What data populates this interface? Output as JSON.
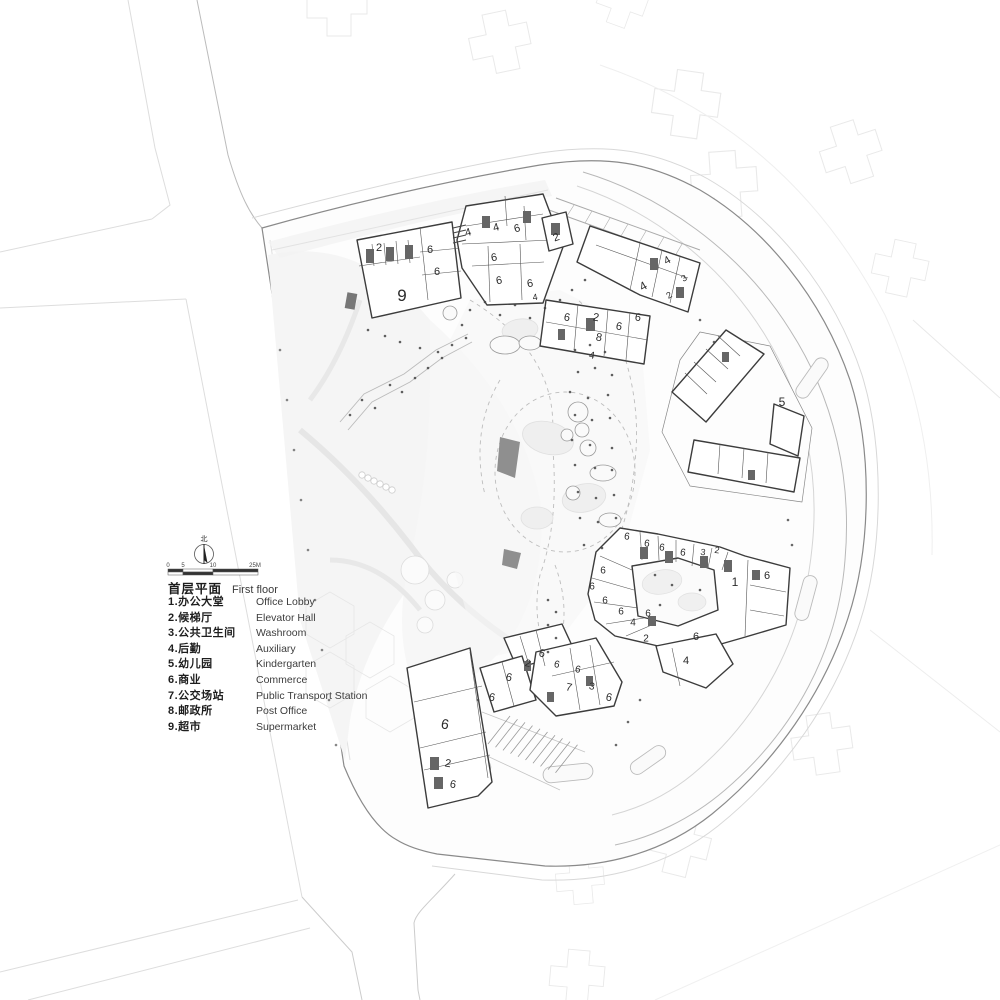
{
  "legend": {
    "title_zh": "首层平面",
    "title_en": "First floor",
    "compass_label": "北",
    "scale_labels": [
      "0",
      "5",
      "10",
      "25M"
    ],
    "items": [
      {
        "num": "1",
        "zh": "办公大堂",
        "en": "Office Lobby"
      },
      {
        "num": "2",
        "zh": "候梯厅",
        "en": "Elevator Hall"
      },
      {
        "num": "3",
        "zh": "公共卫生间",
        "en": "Washroom"
      },
      {
        "num": "4",
        "zh": "后勤",
        "en": "Auxiliary"
      },
      {
        "num": "5",
        "zh": "幼儿园",
        "en": "Kindergarten"
      },
      {
        "num": "6",
        "zh": "商业",
        "en": "Commerce"
      },
      {
        "num": "7",
        "zh": "公交场站",
        "en": "Public Transport Station"
      },
      {
        "num": "8",
        "zh": "邮政所",
        "en": "Post Office"
      },
      {
        "num": "9",
        "zh": "超市",
        "en": "Supermarket"
      }
    ]
  },
  "plan": {
    "labels": [
      {
        "x": 379,
        "y": 247,
        "t": "2",
        "s": 11,
        "r": 0
      },
      {
        "x": 430,
        "y": 249,
        "t": "6",
        "s": 11,
        "r": 0
      },
      {
        "x": 437,
        "y": 271,
        "t": "6",
        "s": 11,
        "r": 0
      },
      {
        "x": 402,
        "y": 295,
        "t": "9",
        "s": 17,
        "r": 0
      },
      {
        "x": 468,
        "y": 232,
        "t": "4",
        "s": 11,
        "r": -15
      },
      {
        "x": 496,
        "y": 227,
        "t": "4",
        "s": 11,
        "r": -15
      },
      {
        "x": 517,
        "y": 228,
        "t": "6",
        "s": 11,
        "r": -15
      },
      {
        "x": 494,
        "y": 257,
        "t": "6",
        "s": 11,
        "r": -10
      },
      {
        "x": 499,
        "y": 280,
        "t": "6",
        "s": 11,
        "r": -10
      },
      {
        "x": 530,
        "y": 283,
        "t": "6",
        "s": 11,
        "r": -10
      },
      {
        "x": 535,
        "y": 297,
        "t": "4",
        "s": 9,
        "r": -10
      },
      {
        "x": 556,
        "y": 237,
        "t": "2",
        "s": 11,
        "r": -20
      },
      {
        "x": 667,
        "y": 260,
        "t": "4",
        "s": 11,
        "r": -30
      },
      {
        "x": 643,
        "y": 286,
        "t": "4",
        "s": 12,
        "r": -30
      },
      {
        "x": 684,
        "y": 278,
        "t": "3",
        "s": 9,
        "r": -30
      },
      {
        "x": 669,
        "y": 295,
        "t": "2",
        "s": 9,
        "r": -30
      },
      {
        "x": 567,
        "y": 317,
        "t": "6",
        "s": 11,
        "r": 10
      },
      {
        "x": 596,
        "y": 317,
        "t": "2",
        "s": 11,
        "r": 10
      },
      {
        "x": 638,
        "y": 317,
        "t": "6",
        "s": 11,
        "r": 10
      },
      {
        "x": 619,
        "y": 326,
        "t": "6",
        "s": 11,
        "r": 10
      },
      {
        "x": 599,
        "y": 337,
        "t": "8",
        "s": 11,
        "r": 10
      },
      {
        "x": 592,
        "y": 355,
        "t": "4",
        "s": 10,
        "r": 10
      },
      {
        "x": 782,
        "y": 402,
        "t": "5",
        "s": 12,
        "r": 0
      },
      {
        "x": 627,
        "y": 536,
        "t": "6",
        "s": 10,
        "r": 8
      },
      {
        "x": 647,
        "y": 543,
        "t": "6",
        "s": 10,
        "r": 8
      },
      {
        "x": 662,
        "y": 547,
        "t": "6",
        "s": 10,
        "r": 8
      },
      {
        "x": 683,
        "y": 552,
        "t": "6",
        "s": 10,
        "r": 8
      },
      {
        "x": 703,
        "y": 552,
        "t": "3",
        "s": 9,
        "r": 8
      },
      {
        "x": 717,
        "y": 550,
        "t": "2",
        "s": 9,
        "r": 8
      },
      {
        "x": 735,
        "y": 582,
        "t": "1",
        "s": 12,
        "r": 0
      },
      {
        "x": 767,
        "y": 575,
        "t": "6",
        "s": 11,
        "r": 0
      },
      {
        "x": 603,
        "y": 570,
        "t": "6",
        "s": 10,
        "r": 0
      },
      {
        "x": 592,
        "y": 586,
        "t": "6",
        "s": 10,
        "r": 0
      },
      {
        "x": 605,
        "y": 600,
        "t": "6",
        "s": 10,
        "r": 0
      },
      {
        "x": 621,
        "y": 611,
        "t": "6",
        "s": 10,
        "r": 0
      },
      {
        "x": 648,
        "y": 613,
        "t": "6",
        "s": 10,
        "r": 0
      },
      {
        "x": 633,
        "y": 622,
        "t": "4",
        "s": 10,
        "r": 0
      },
      {
        "x": 646,
        "y": 638,
        "t": "2",
        "s": 10,
        "r": 0
      },
      {
        "x": 696,
        "y": 636,
        "t": "6",
        "s": 11,
        "r": 0
      },
      {
        "x": 686,
        "y": 660,
        "t": "4",
        "s": 11,
        "r": 0
      },
      {
        "x": 542,
        "y": 653,
        "t": "6",
        "s": 11,
        "r": 12
      },
      {
        "x": 528,
        "y": 663,
        "t": "2",
        "s": 10,
        "r": 12
      },
      {
        "x": 557,
        "y": 664,
        "t": "6",
        "s": 10,
        "r": 12
      },
      {
        "x": 578,
        "y": 669,
        "t": "6",
        "s": 10,
        "r": 12
      },
      {
        "x": 509,
        "y": 677,
        "t": "6",
        "s": 11,
        "r": 12
      },
      {
        "x": 492,
        "y": 697,
        "t": "6",
        "s": 11,
        "r": 12
      },
      {
        "x": 569,
        "y": 687,
        "t": "7",
        "s": 11,
        "r": 12
      },
      {
        "x": 592,
        "y": 686,
        "t": "3",
        "s": 10,
        "r": 12
      },
      {
        "x": 609,
        "y": 697,
        "t": "6",
        "s": 11,
        "r": 12
      },
      {
        "x": 445,
        "y": 724,
        "t": "6",
        "s": 14,
        "r": 10
      },
      {
        "x": 448,
        "y": 763,
        "t": "2",
        "s": 11,
        "r": 10
      },
      {
        "x": 453,
        "y": 784,
        "t": "6",
        "s": 11,
        "r": 10
      }
    ]
  },
  "colors": {
    "building_outline": "#3c3c3c",
    "boundary": "#8a8a8a",
    "label": "#2b2b2b"
  }
}
